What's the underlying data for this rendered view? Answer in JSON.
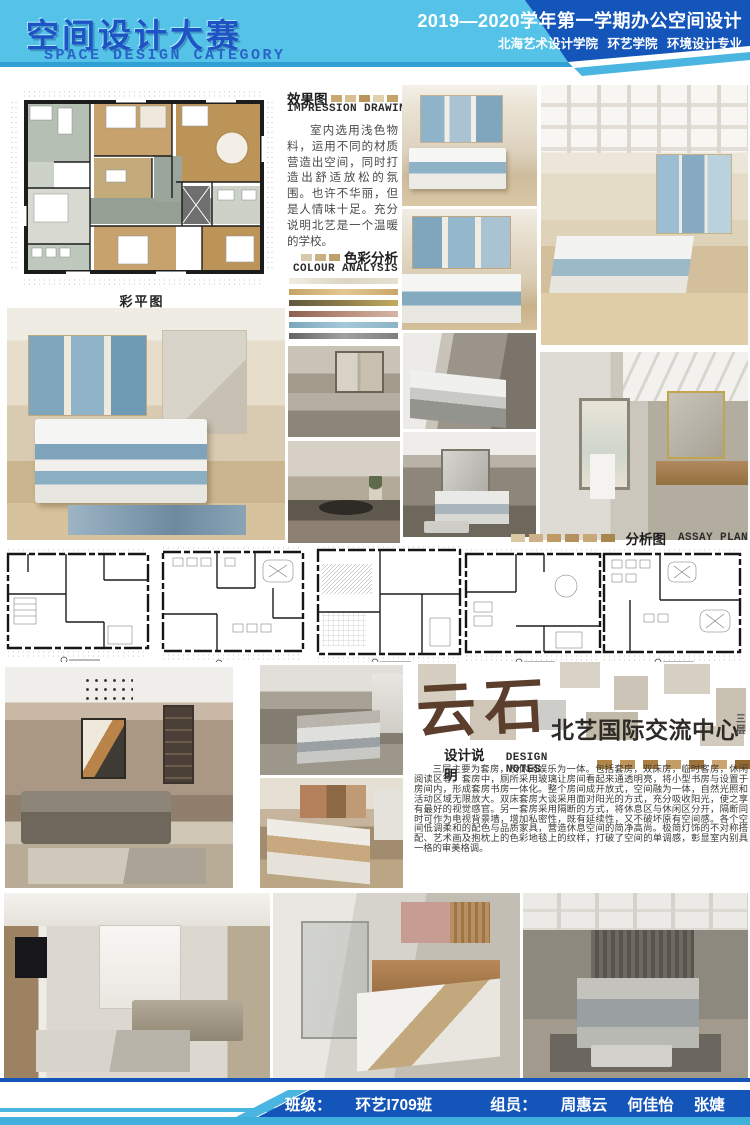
{
  "header": {
    "title_cn": "空间设计大赛",
    "title_en": "SPACE DESIGN CATEGORY",
    "course": "2019—2020学年第一学期办公空间设计",
    "school": "北海艺术设计学院 环艺学院 环境设计专业"
  },
  "impression": {
    "label_cn": "效果图",
    "label_en": "IMPRESSION DRAWING",
    "body": "室内选用浅色物料，运用不同的材质营造出空间，同时打造出舒适放松的氛围。也许不华丽，但是人情味十足。充分说明北艺是一个温暖的学校。"
  },
  "colour": {
    "label_cn": "色彩分析",
    "label_en": "COLOUR ANALYSIS",
    "bars": [
      {
        "name": "cream",
        "style": "background:linear-gradient(90deg,#f0ede1,#dcd5c3,#e6e0d1)"
      },
      {
        "name": "tan",
        "style": "background:linear-gradient(90deg,#c7a365,#e2c892,#c9a669)"
      },
      {
        "name": "olive-gold",
        "style": "background:linear-gradient(90deg,#5f5740,#8f7d4a,#c3ac60)"
      },
      {
        "name": "mauve",
        "style": "background:linear-gradient(90deg,#8c5f50,#b98c7a,#d6b5a4)"
      },
      {
        "name": "blue",
        "style": "background:linear-gradient(90deg,#7aa6bc,#a5c8d8,#8db4c6)"
      },
      {
        "name": "gray",
        "style": "background:linear-gradient(90deg,#646464,#a0a0a0,#7e7e7e)"
      }
    ]
  },
  "captions": {
    "colour_plan": "彩平图"
  },
  "assay": {
    "label_cn": "分析图",
    "label_en": "ASSAY PLAN"
  },
  "project": {
    "logo": "云石",
    "title": "北艺国际交流中心",
    "floor": "三层"
  },
  "notes": {
    "label_cn": "设计说明",
    "label_en": "DESIGN NOTES",
    "body": "三层主要为套房，及休闲娱乐为一体。包括套房，双床房，临时客房，休闲阅读区等。套房中，厕所采用玻璃让房间看起来通透明亮，将小型书房与设置于房间内，形成套房书房一体化。整个房间成开放式，空间融为一体，自然光照和活动区域无限放大。双床套房大谈采用面对阳光的方式，充分吸收阳光，使之享有最好的视觉感官。另一套房采用隔断的方式，将休息区与休闲区分开，隔断同时可作为电视背景墙，增加私密性，既有延续性，又不破坏原有空间感。各个空间低调柔和的配色与品质家具，营造休息空间的简净高尚。极简灯饰的不对称搭配、艺术画及抱枕上的色彩地毯上的纹样，打破了空间的单调感，彰显室内别具一格的审美格调。"
  },
  "footer": {
    "class_label": "班级：",
    "class_value": "环艺I709班",
    "members_label": "组员：",
    "members": [
      "周惠云",
      "何佳怡",
      "张婕"
    ]
  },
  "palette": {
    "light_blue": "#54c2e8",
    "navy": "#1355b8",
    "title_blue": "#1d53c4",
    "cyan_strip": "#49b5e0",
    "logo_brown": "#5c3e2c"
  }
}
